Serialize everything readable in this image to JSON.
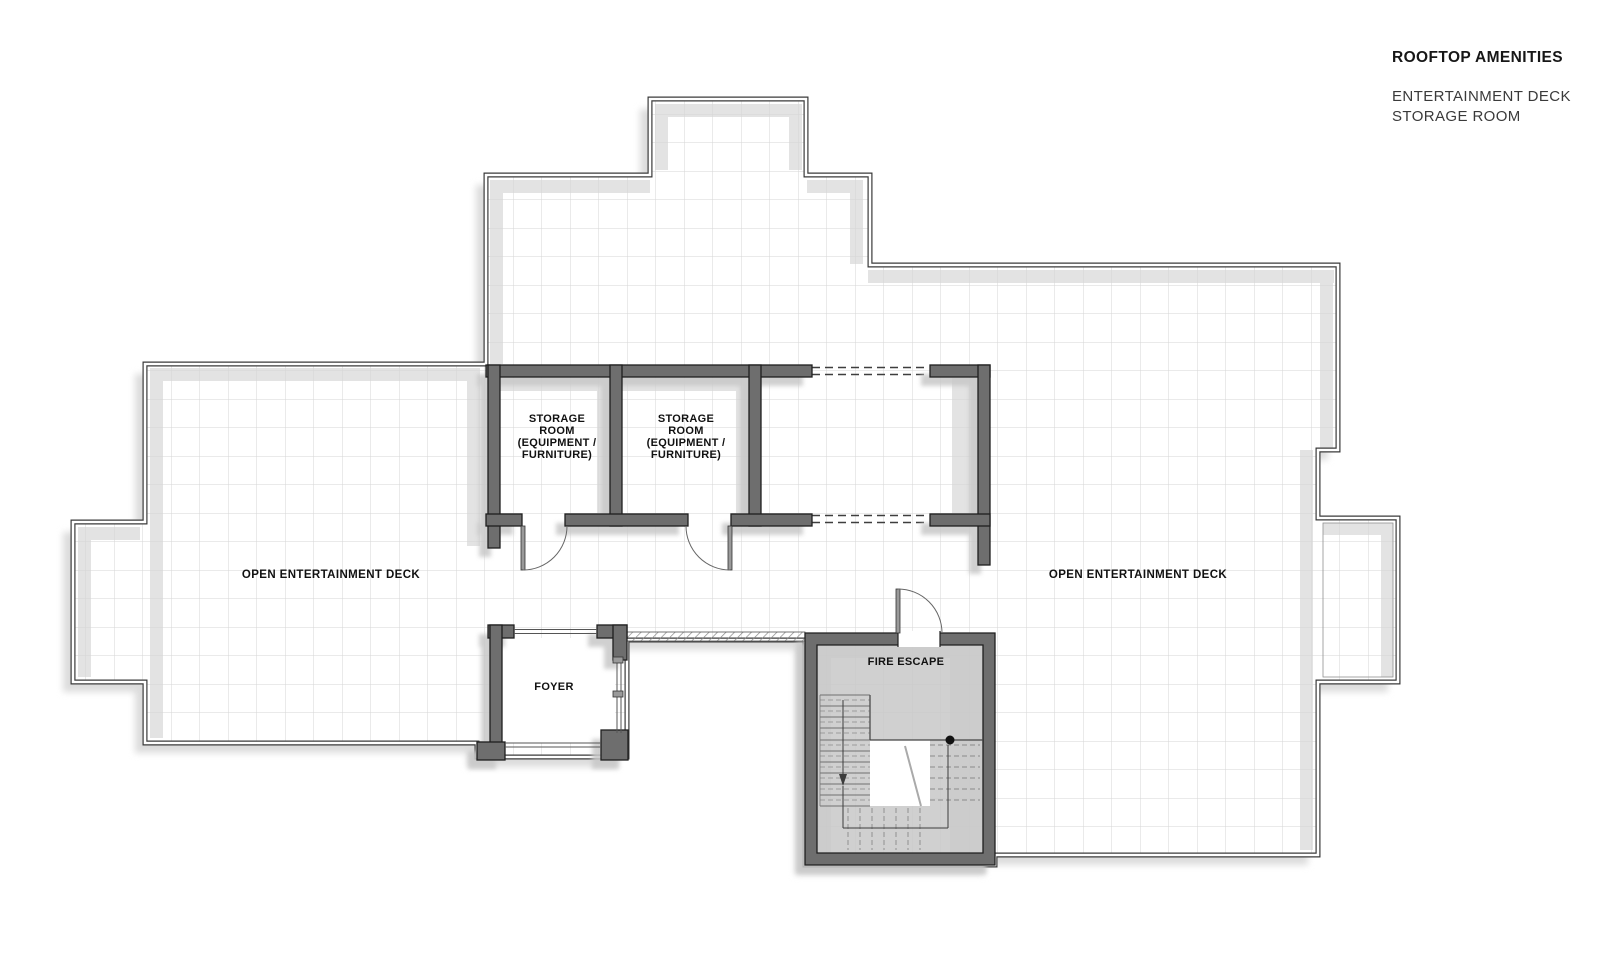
{
  "title_block": {
    "title": "ROOFTOP AMENITIES",
    "subtitle_line1": "ENTERTAINMENT DECK",
    "subtitle_line2": "STORAGE ROOM"
  },
  "plan": {
    "labels": {
      "storage_room_1": {
        "line1": "STORAGE",
        "line2": "ROOM",
        "line3": "(EQUIPMENT /",
        "line4": "FURNITURE)"
      },
      "storage_room_2": {
        "line1": "STORAGE",
        "line2": "ROOM",
        "line3": "(EQUIPMENT /",
        "line4": "FURNITURE)"
      },
      "open_deck_left": "OPEN ENTERTAINMENT DECK",
      "open_deck_right": "OPEN ENTERTAINMENT DECK",
      "foyer": "FOYER",
      "fire_escape": "FIRE ESCAPE"
    },
    "colors": {
      "background": "#ffffff",
      "wall_fill": "#6e6e6e",
      "wall_outline": "#1f1f1f",
      "parapet_line": "#3a3a3a",
      "grid_line": "#d6d6d6",
      "inner_shadow": "#e3e3e3",
      "drop_shadow": "#dcdcdc",
      "label_text": "#111111"
    }
  }
}
